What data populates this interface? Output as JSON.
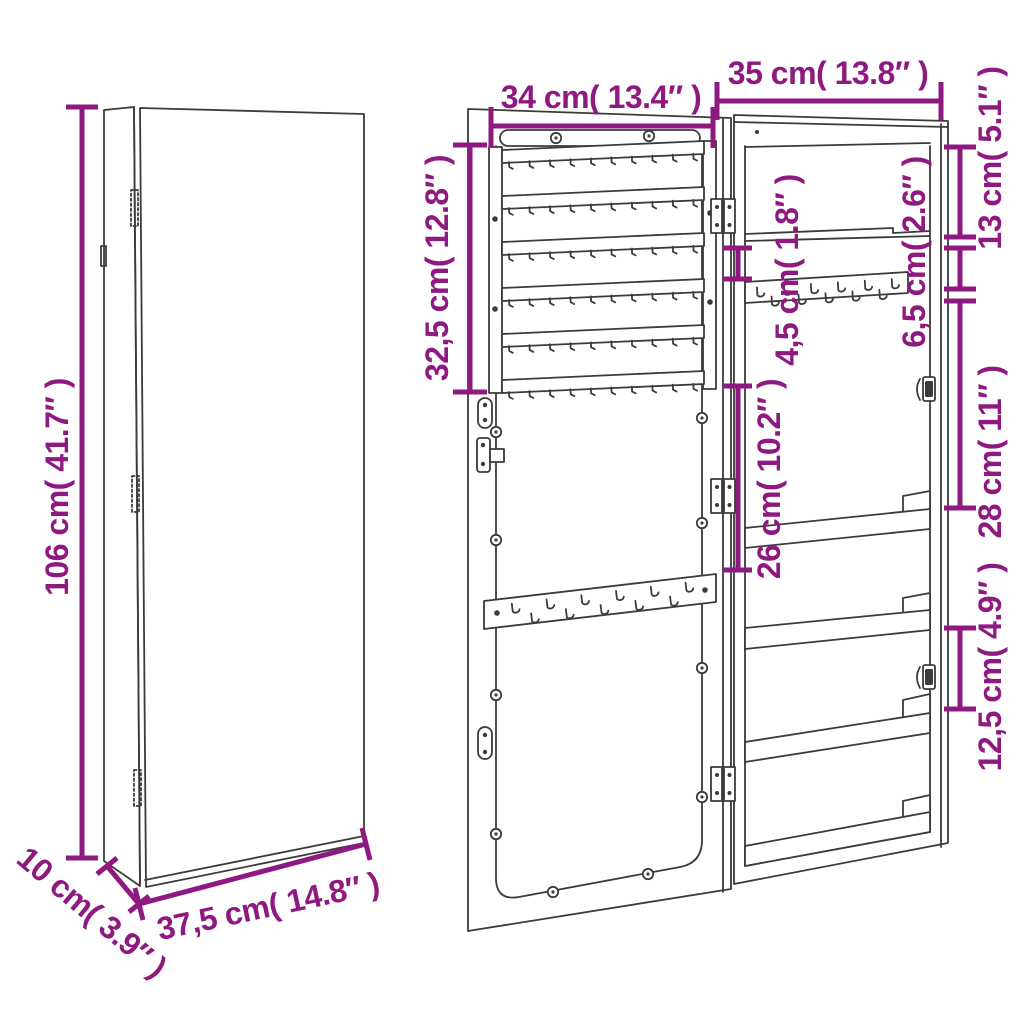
{
  "colors": {
    "dimension": "#8E1980",
    "line": "#3b3b3b",
    "background": "#ffffff"
  },
  "closed_view": {
    "height": "106 cm( 41.7″ )",
    "depth": "10 cm( 3.9″ )",
    "width": "37,5 cm( 14.8″ )"
  },
  "open_view": {
    "door_inner_width": "34 cm( 13.4″ )",
    "cabinet_width": "35 cm( 13.8″ )",
    "earring_rack_height": "32,5 cm( 12.8″ )",
    "shelf_to_hooks_gap": "4,5 cm( 1.8″ )",
    "door_lower_section": "26 cm( 10.2″ )",
    "top_compartment_height": "13 cm( 5.1″ )",
    "hook_rail_height": "6,5 cm( 2.6″ )",
    "shelf_section_height": "28 cm( 11″ )",
    "bottom_shelf_gap": "12,5 cm( 4.9″ )"
  }
}
